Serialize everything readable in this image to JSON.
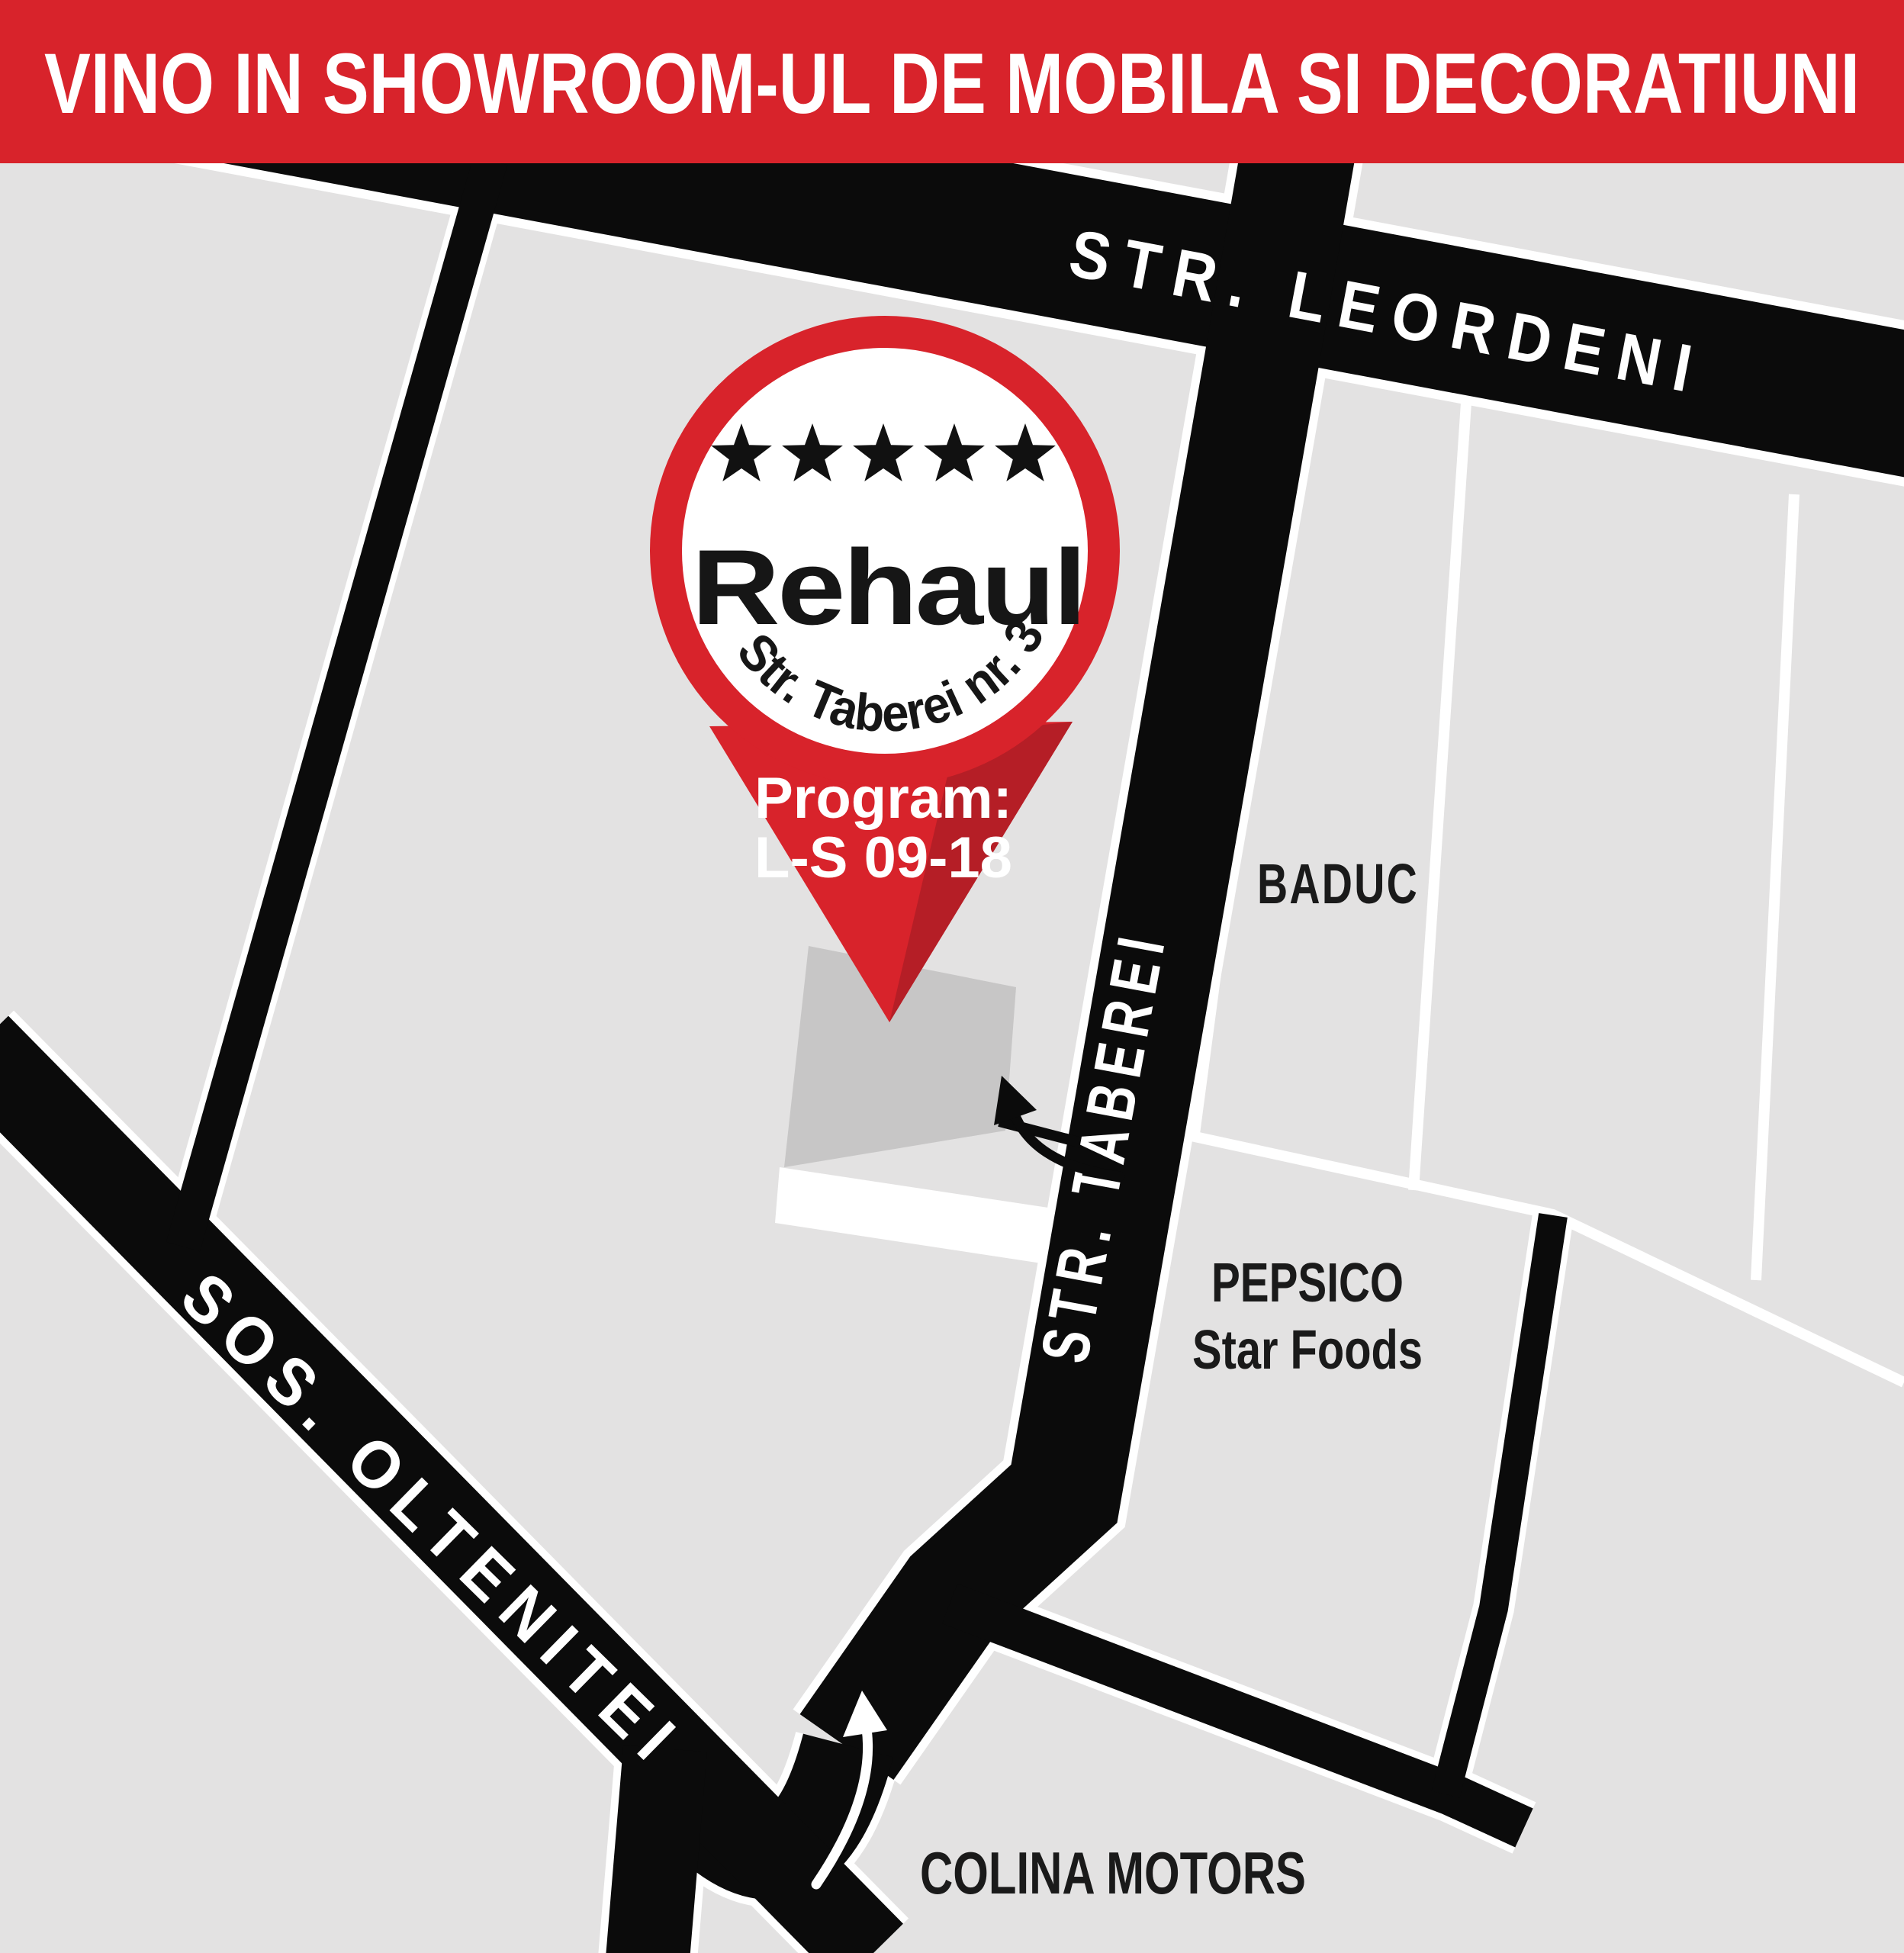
{
  "banner": {
    "headline": "VINO IN SHOWROOM-UL DE MOBILA SI DECORATIUNI"
  },
  "streets": {
    "leordeni": "STR. LEORDENI",
    "taberei": "STR. TABEREI",
    "oltenitei": "SOS. OLTENITEI"
  },
  "places": {
    "baduc": "BADUC",
    "pepsico_line1": "PEPSICO",
    "pepsico_line2": "Star Foods",
    "colina_motors": "COLINA MOTORS"
  },
  "pin": {
    "stars_count": 5,
    "brand": "Rehaul",
    "address": "Str. Taberei nr. 3",
    "schedule_label": "Program:",
    "schedule_hours": "L-S 09-18"
  },
  "colors": {
    "red": "#d8232b",
    "dark_red": "#b51e26",
    "road_black": "#0b0b0b",
    "map_gray": "#e3e2e2",
    "building_gray": "#c7c6c6",
    "white": "#ffffff"
  }
}
